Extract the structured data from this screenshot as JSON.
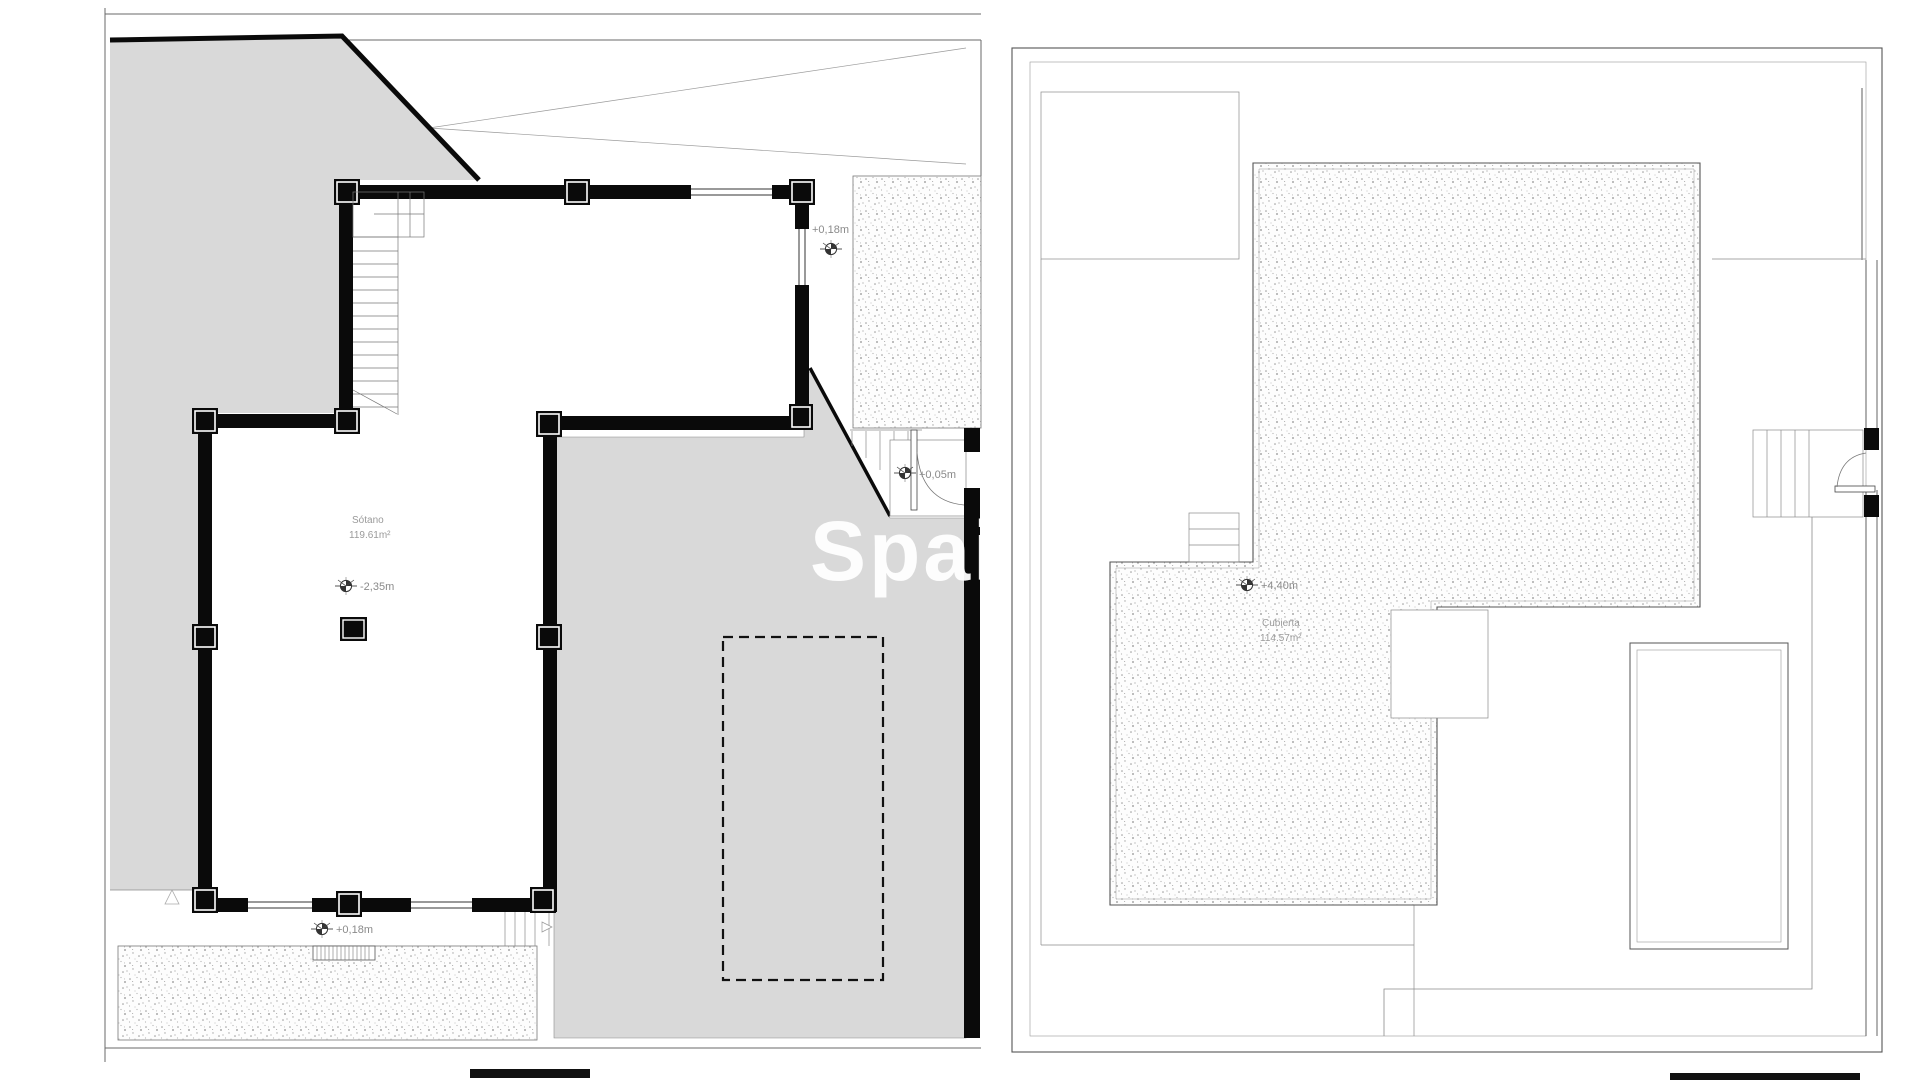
{
  "watermark": "Spain",
  "left_plan": {
    "title": "basement-floor-plan",
    "room_label": "Sótano",
    "room_area": "119.61m²",
    "level_top_right": "+0,18m",
    "level_door": "+0,05m",
    "level_center": "-2,35m",
    "level_bottom": "+0,18m"
  },
  "right_plan": {
    "title": "roof-floor-plan",
    "room_label": "Cubierta",
    "room_area": "114.57m²",
    "level_center": "+4,40m"
  },
  "colors": {
    "wall": "#0a0a0a",
    "terrain_gray": "#d9d9d9",
    "thin_line": "#666666",
    "label_text": "#8a8a8a",
    "paper": "#ffffff"
  }
}
